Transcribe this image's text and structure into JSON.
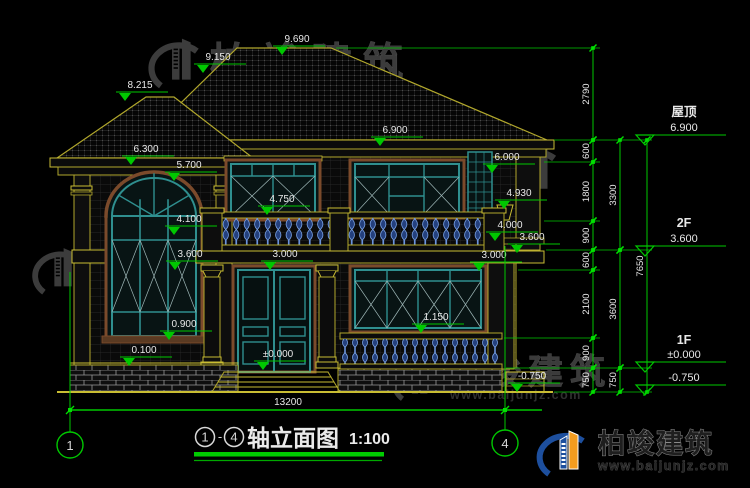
{
  "drawing": {
    "title": {
      "axis_start": "1",
      "axis_end": "4",
      "separator": "-",
      "name": "轴立面图",
      "scale": "1:100"
    },
    "overall_width_mm": "13200",
    "axis_bubbles": [
      {
        "label": "1",
        "x": 70,
        "y": 445
      },
      {
        "label": "4",
        "x": 505,
        "y": 443
      }
    ],
    "right_levels": [
      {
        "label": "屋顶",
        "value": "6.900",
        "cx": 684,
        "label_y": 116,
        "value_y": 131,
        "line_y": 135
      },
      {
        "label": "2F",
        "value": "3.600",
        "cx": 684,
        "label_y": 227,
        "value_y": 242,
        "line_y": 246
      },
      {
        "label": "1F",
        "value": "±0.000",
        "cx": 684,
        "label_y": 344,
        "value_y": 358,
        "line_y": 362
      },
      {
        "label": "",
        "value": "-0.750",
        "cx": 684,
        "label_y": 0,
        "value_y": 381,
        "line_y": 385
      }
    ],
    "elevation_marks": [
      {
        "value": "9.690",
        "x": 297,
        "y": 42
      },
      {
        "value": "9.150",
        "x": 218,
        "y": 60
      },
      {
        "value": "8.215",
        "x": 140,
        "y": 88
      },
      {
        "value": "6.900",
        "x": 395,
        "y": 133
      },
      {
        "value": "6.300",
        "x": 146,
        "y": 152
      },
      {
        "value": "6.000",
        "x": 507,
        "y": 160
      },
      {
        "value": "5.700",
        "x": 189,
        "y": 168
      },
      {
        "value": "4.930",
        "x": 519,
        "y": 196
      },
      {
        "value": "4.750",
        "x": 282,
        "y": 202
      },
      {
        "value": "4.100",
        "x": 189,
        "y": 222
      },
      {
        "value": "4.000",
        "x": 510,
        "y": 228
      },
      {
        "value": "3.600",
        "x": 532,
        "y": 240
      },
      {
        "value": "3.600",
        "x": 190,
        "y": 257
      },
      {
        "value": "3.000",
        "x": 285,
        "y": 257
      },
      {
        "value": "3.000",
        "x": 494,
        "y": 258
      },
      {
        "value": "1.150",
        "x": 436,
        "y": 320
      },
      {
        "value": "0.900",
        "x": 184,
        "y": 327
      },
      {
        "value": "0.100",
        "x": 144,
        "y": 353
      },
      {
        "value": "±0.000",
        "x": 278,
        "y": 357
      },
      {
        "value": "-0.750",
        "x": 532,
        "y": 379
      }
    ],
    "dim_chains": [
      {
        "x": 593,
        "segments": [
          {
            "v": "2790",
            "y1": 48,
            "y2": 140
          },
          {
            "v": "600",
            "y1": 140,
            "y2": 162
          },
          {
            "v": "1800",
            "y1": 162,
            "y2": 221
          },
          {
            "v": "900",
            "y1": 221,
            "y2": 250
          },
          {
            "v": "600",
            "y1": 250,
            "y2": 270
          },
          {
            "v": "2100",
            "y1": 270,
            "y2": 338
          },
          {
            "v": "900",
            "y1": 338,
            "y2": 368
          },
          {
            "v": "750",
            "y1": 368,
            "y2": 392
          }
        ]
      },
      {
        "x": 620,
        "segments": [
          {
            "v": "3300",
            "y1": 140,
            "y2": 250
          },
          {
            "v": "3600",
            "y1": 250,
            "y2": 368
          },
          {
            "v": "750",
            "y1": 368,
            "y2": 392
          }
        ]
      },
      {
        "x": 647,
        "segments": [
          {
            "v": "7650",
            "y1": 140,
            "y2": 392
          }
        ]
      }
    ],
    "watermarks": [
      {
        "logo_x": 146,
        "logo_y": 30,
        "logo_size": 62,
        "brand_x": 210,
        "brand_y": 76,
        "brand_fs": 40,
        "brand_ls": 11,
        "url_x": 226,
        "url_y": 95,
        "url_fs": 14,
        "show_text": true
      },
      {
        "logo_x": 30,
        "logo_y": 240,
        "logo_size": 58,
        "brand_x": 92,
        "brand_y": 284,
        "brand_fs": 35,
        "brand_ls": 7,
        "url_x": 96,
        "url_y": 299,
        "url_fs": 13,
        "show_text": true
      },
      {
        "logo_x": 390,
        "logo_y": 352,
        "logo_size": 52,
        "brand_x": 444,
        "brand_y": 384,
        "brand_fs": 35,
        "brand_ls": 7,
        "url_x": 450,
        "url_y": 399,
        "url_fs": 12.5,
        "show_text": true
      },
      {
        "logo_x": 500,
        "logo_y": 136,
        "logo_size": 66,
        "show_text": false
      }
    ],
    "brand": {
      "name": "柏竣建筑",
      "url": "www.baijunjz.com"
    },
    "footer_logo": {
      "name": "柏竣建筑",
      "url": "www.baijunjz.com"
    },
    "colors": {
      "cad_green": "#00c800",
      "cad_yellow": "#c9bd33",
      "line_olive": "#b1a72c",
      "window_teal": "#2f8f8f",
      "baluster_blue": "#7aa3e8",
      "trim_brown": "#7b4a2b",
      "dim_white": "#e8e8e8"
    }
  }
}
